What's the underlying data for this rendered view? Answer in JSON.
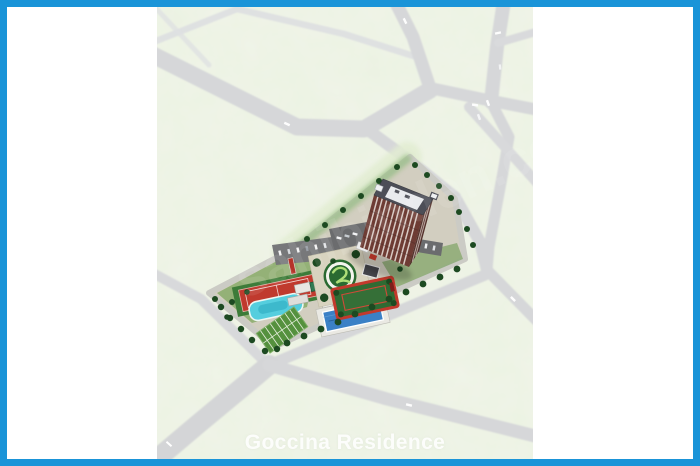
{
  "photo": {
    "caption": "Goccina Residence",
    "watermark": "sahibinden.com",
    "frame_color": "#1a94d8",
    "background_color": "#ffffff",
    "map_palette": {
      "grass": "#eef2e5",
      "road": "#d7d8da",
      "site_ground": "#d2cec0",
      "tower_facade": "#6e3c34",
      "tower_roof": "#4c4e57",
      "tennis_court": "#c23b2f",
      "leisure_pool": "#55cede",
      "swimming_pool": "#3b80c6",
      "lawn": "#57923f",
      "emblem_disc": "#2a6a31",
      "emblem_ring": "#ffffff",
      "garden_track_border": "#c2392c"
    },
    "elements": [
      "road-network",
      "residential-tower",
      "tennis-court",
      "leisure-pool",
      "swimming-pool",
      "pool-house",
      "circular-emblem-plaza",
      "garden-track",
      "grass-parking",
      "parking-lots",
      "perimeter-trees"
    ]
  }
}
